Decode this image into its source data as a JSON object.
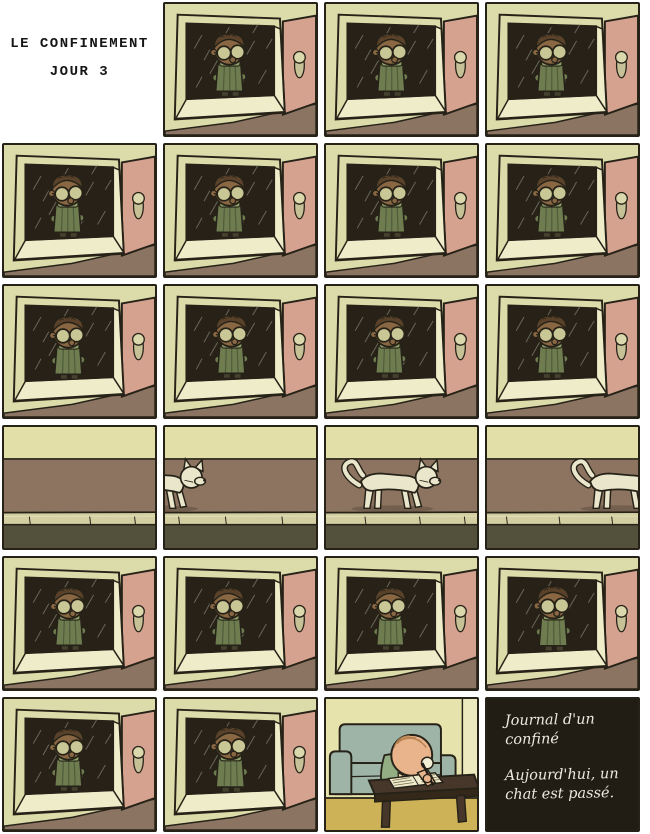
{
  "title": {
    "line1": "LE CONFINEMENT",
    "line2": "JOUR 3"
  },
  "journal": {
    "para1": "Journal d'un confiné",
    "para2": "Aujourd'hui, un chat est passé."
  },
  "colors": {
    "line": "#262218",
    "wall": "#dcdcaa",
    "sill": "#efecca",
    "glass": "#272117",
    "rain": "#a8ad9a",
    "door": "#d5a28f",
    "handle_plate": "#c6c197",
    "handle_knob": "#dcd8ad",
    "ground": "#8b7461",
    "skin": "#8a6743",
    "hair": "#5a422a",
    "lens": "#c9c795",
    "coat": "#6e7c50",
    "coat_dark": "#4e5c3a",
    "scarf": "#8fa06b",
    "pants": "#45412f",
    "street_wall": "#e2dfa9",
    "sidewalk": "#8c7460",
    "curb": "#d4cfa2",
    "curb_light": "#e3dfb6",
    "road": "#53513b",
    "cat": "#eae6cb",
    "shadow": "#5f4f3f",
    "writing_wall": "#e6e3ad",
    "writing_wall_right": "#ebe9bd",
    "floor": "#cdb257",
    "couch": "#9db4a6",
    "table": "#46372a",
    "table_dark": "#332819",
    "paper": "#efeacc",
    "scribble": "#76704f",
    "skin_light": "#e9b48b",
    "hair_light": "#b5824f",
    "shirt": "#93ae83",
    "glasses_side": "#f2eed6",
    "pen": "#1f1c16",
    "journal_bg": "#211d15",
    "journal_text": "#ece8dc"
  },
  "panels": [
    {
      "type": "title"
    },
    {
      "type": "window",
      "pose": {
        "dx": 0,
        "dy": 0
      }
    },
    {
      "type": "window",
      "pose": {
        "dx": 1,
        "dy": 0
      }
    },
    {
      "type": "window",
      "pose": {
        "dx": 0,
        "dy": 0
      }
    },
    {
      "type": "window",
      "pose": {
        "dx": -1,
        "dy": 0
      }
    },
    {
      "type": "window",
      "pose": {
        "dx": 0,
        "dy": 0
      }
    },
    {
      "type": "window",
      "pose": {
        "dx": 1,
        "dy": 0
      }
    },
    {
      "type": "window",
      "pose": {
        "dx": 0,
        "dy": 0
      }
    },
    {
      "type": "window",
      "pose": {
        "dx": 0,
        "dy": 1
      }
    },
    {
      "type": "window",
      "pose": {
        "dx": 2,
        "dy": 0
      }
    },
    {
      "type": "window",
      "pose": {
        "dx": -1,
        "dy": 0
      }
    },
    {
      "type": "window",
      "pose": {
        "dx": 0,
        "dy": 0
      }
    },
    {
      "type": "street",
      "cat_dx": null,
      "joints": [
        26,
        88,
        134
      ]
    },
    {
      "type": "street",
      "cat_dx": -68,
      "joints": [
        14,
        62,
        120
      ]
    },
    {
      "type": "street",
      "cat_dx": 8,
      "joints": [
        40,
        96,
        142
      ]
    },
    {
      "type": "street",
      "cat_dx": 78,
      "joints": [
        20,
        74,
        128
      ]
    },
    {
      "type": "window",
      "pose": {
        "dx": 1,
        "dy": 0
      }
    },
    {
      "type": "window",
      "pose": {
        "dx": -1,
        "dy": 0
      }
    },
    {
      "type": "window",
      "pose": {
        "dx": 0,
        "dy": 0
      }
    },
    {
      "type": "window",
      "pose": {
        "dx": 2,
        "dy": 0,
        "scale": 1.03
      }
    },
    {
      "type": "window",
      "pose": {
        "dx": 0,
        "dy": 0
      }
    },
    {
      "type": "window",
      "pose": {
        "dx": 1,
        "dy": 0,
        "scale": 1.04
      }
    },
    {
      "type": "writing"
    },
    {
      "type": "journal"
    }
  ]
}
